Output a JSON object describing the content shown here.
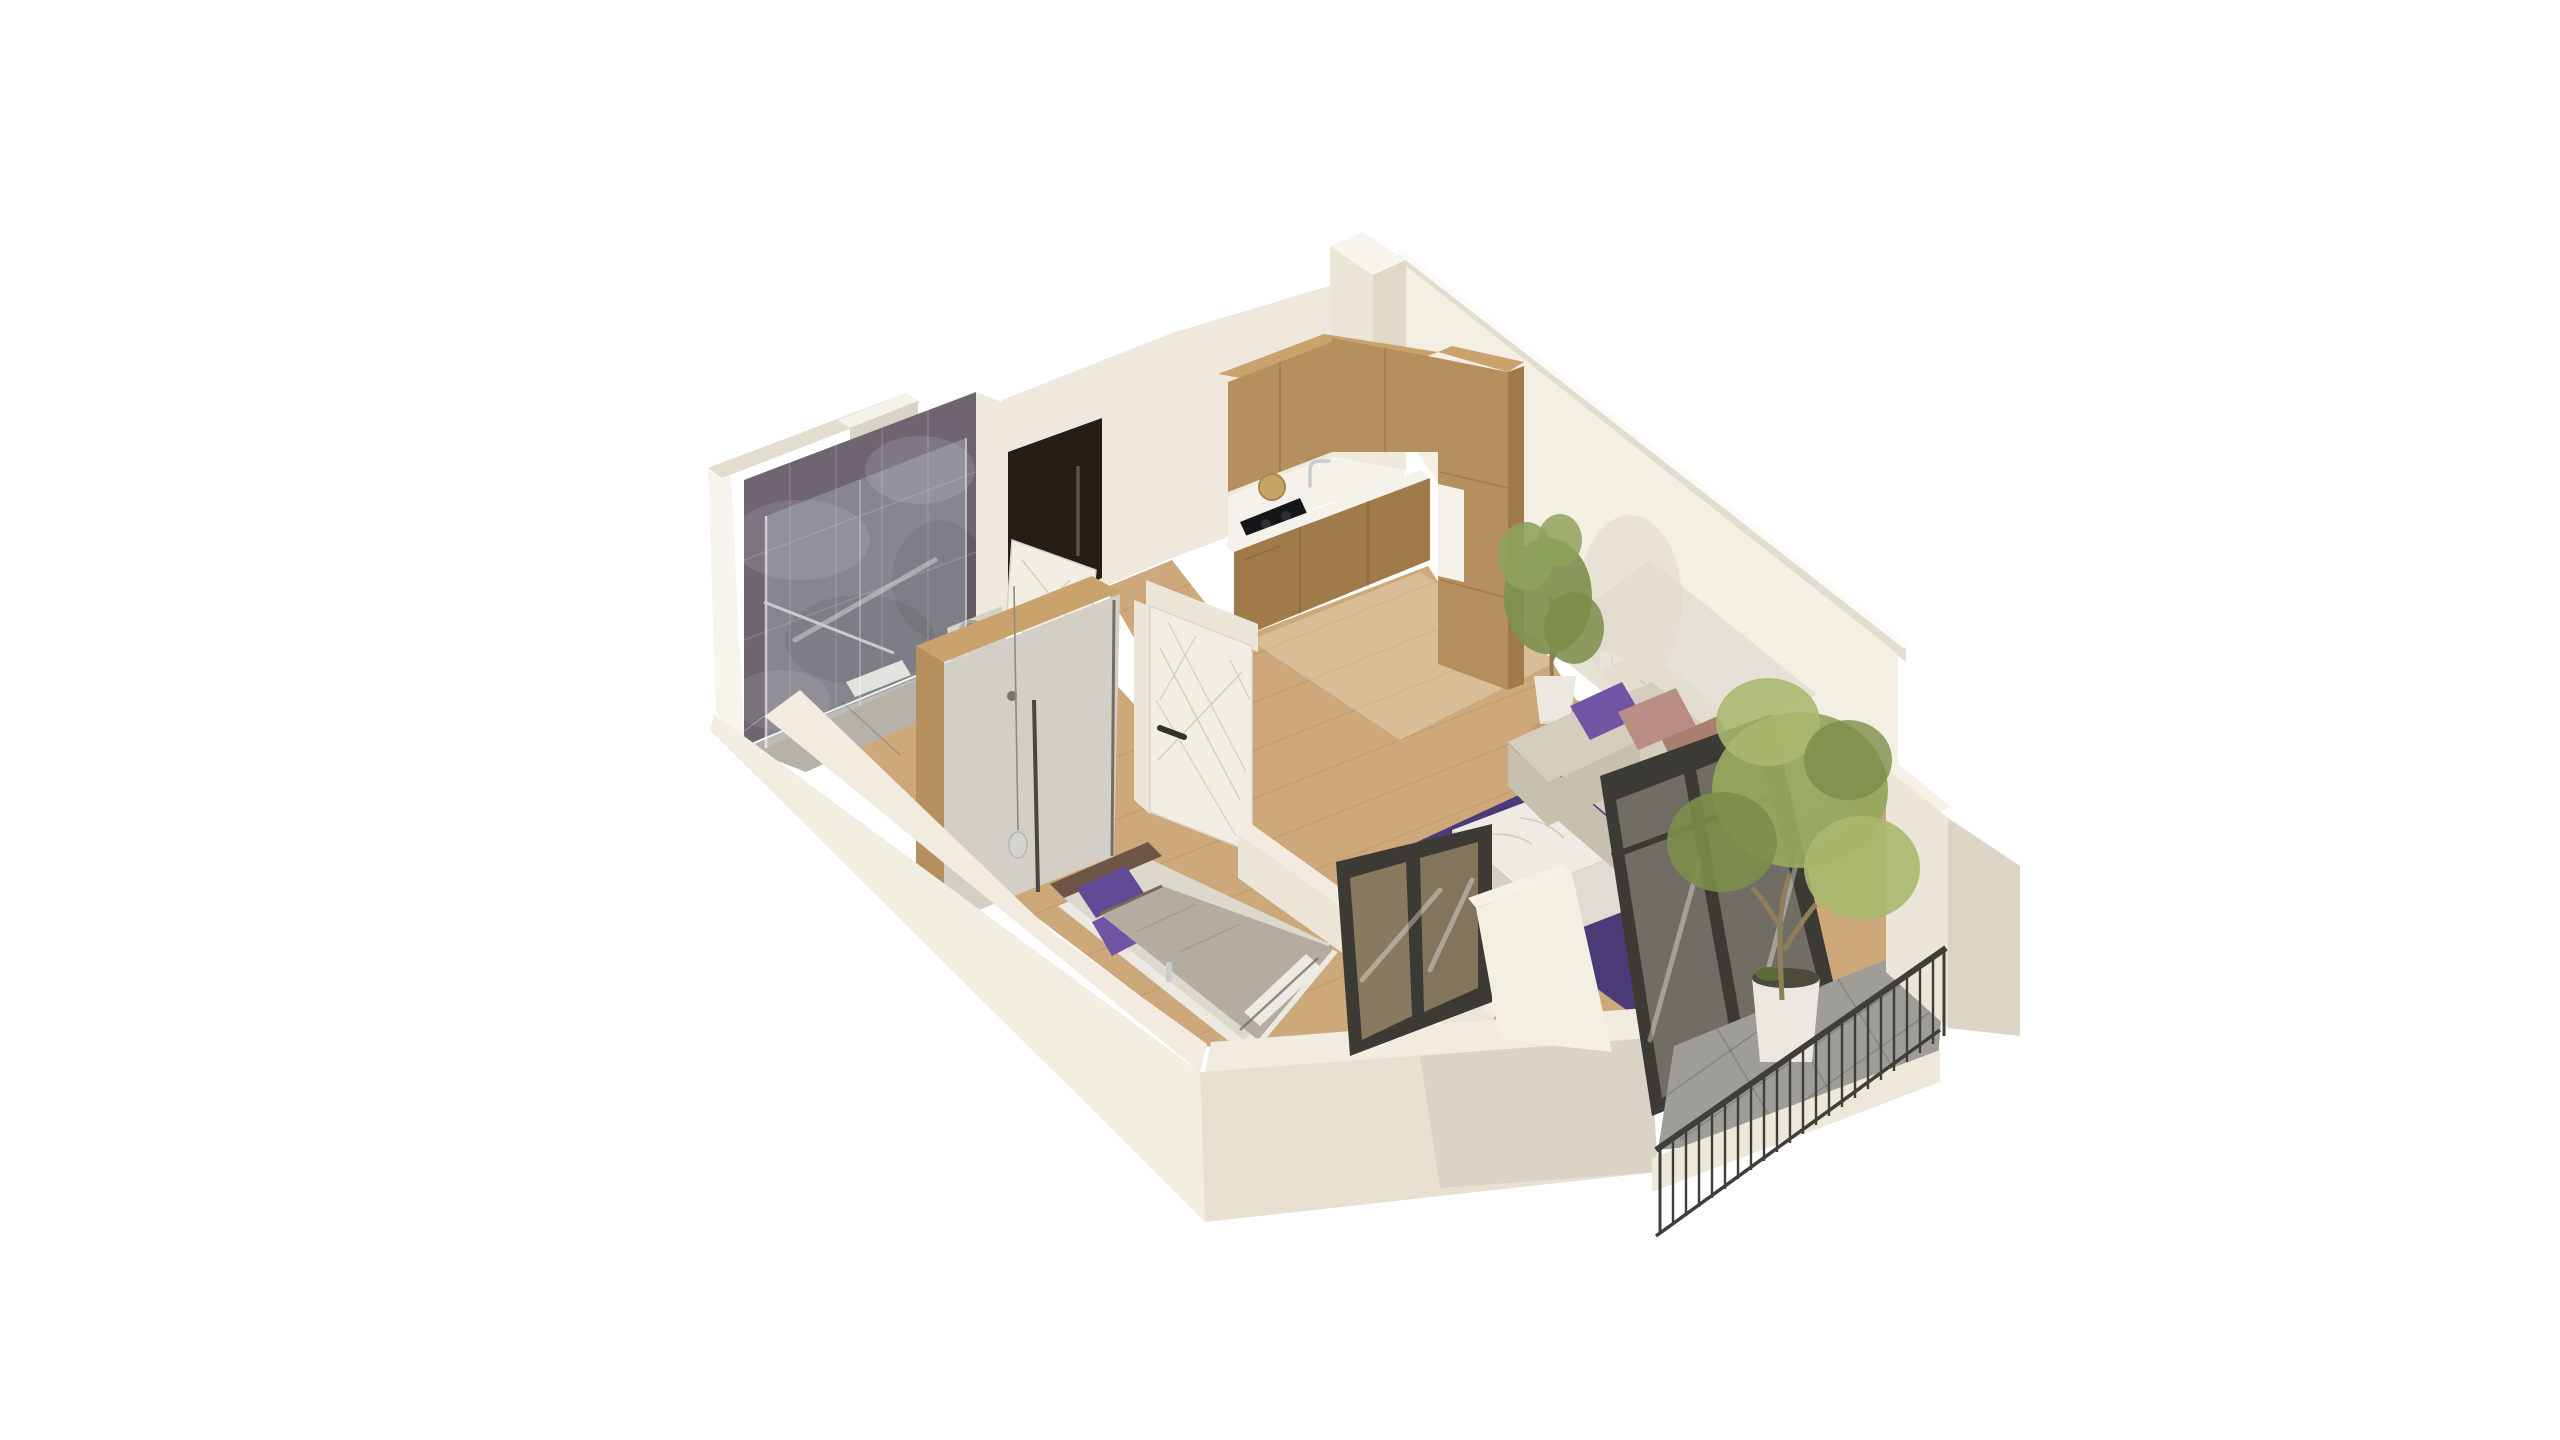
{
  "scene": {
    "type": "isometric-apartment-floorplan-render",
    "description": "Photorealistic 3D dollhouse cutaway of a one-bedroom apartment on a white background",
    "rooms": [
      {
        "name": "bathroom",
        "position": "back-left",
        "features": [
          "dark purple-gray marble tiled walls",
          "glass shower enclosure",
          "chrome towel bar",
          "toilet",
          "vanity with round basin",
          "light tiled floor",
          "bath mat",
          "wall niche"
        ]
      },
      {
        "name": "hallway",
        "position": "center-back",
        "features": [
          "dark entry door with long pull handle",
          "white bathroom door ajar",
          "wood plank floor"
        ]
      },
      {
        "name": "kitchen",
        "position": "back-center",
        "features": [
          "L-shaped light oak cabinets",
          "upper cabinets",
          "tall cabinet column",
          "white countertop and backsplash",
          "black cooktop",
          "chrome faucet",
          "round wooden board",
          "potted plant beside cabinets"
        ]
      },
      {
        "name": "living-room",
        "position": "right",
        "features": [
          "beige corner sofa",
          "purple and dusty-pink cushions",
          "dark purple rug",
          "white marble coffee table",
          "radiator on back wall",
          "black-framed glass sliding door to balcony"
        ]
      },
      {
        "name": "bedroom",
        "position": "front-left",
        "features": [
          "double bed with gray blanket and purple pillows",
          "dark wood headboard",
          "wardrobe with oak frame and gray doors",
          "glass pendant lamp",
          "white paneled door with geometric line pattern",
          "black-framed interior window to living room"
        ]
      },
      {
        "name": "balcony",
        "position": "front-right",
        "features": [
          "gray tile floor",
          "black metal baluster railing",
          "white parapet walls",
          "potted olive tree"
        ]
      }
    ],
    "walls": {
      "style": "cream white plaster, cut low at the front (dollhouse view), full height at the back",
      "tallest_element": "corner pillar at top"
    }
  },
  "colors": {
    "bg": "#ffffff",
    "wallEdgeBright": "#f8f5ee",
    "wallTopBand": "#e3ddd0",
    "wallFaceLight": "#f4efe3",
    "wallFaceMid": "#ece6d9",
    "wallFaceShadow": "#e0d9ca",
    "wallOuterLeft": "#f3eee2",
    "wallOuterRight": "#e8e1d2",
    "wallCutBand": "#f1ecdf",
    "interiorWall": "#efe9dd",
    "niche": "#f5f2e9",
    "nicheShadow": "#d9d3c6",
    "marbleBase": "#6e6570",
    "marbleDark": "#5a525c",
    "marbleLight": "#837a86",
    "entryDoor": "#241d18",
    "entryDoorHandle": "#5a5148",
    "whiteDoor": "#f2eee4",
    "doorPattern": "#d7d1c3",
    "doorHandleDark": "#35302a",
    "woodCabinet": "#b68f5e",
    "woodCabinetTop": "#c9a26c",
    "woodCabinetDark": "#a07a49",
    "counterWhite": "#f4f2eb",
    "cooktopBlack": "#15151a",
    "boardWood": "#c8a366",
    "floorWood": "#cda87a",
    "floorWoodHall": "#c39e6e",
    "floorPlank": "#b28a5e",
    "bathFloor": "#b7b2a9",
    "bathMat": "#e9e7e0",
    "fixtureWhite": "#efede6",
    "vanityGray": "#d6d2c8",
    "basinGray": "#a7a49c",
    "glassBlue": "#cedcde",
    "chrome": "#c9cbcc",
    "rugPurple": "#4a3a78",
    "tableMarble": "#edebe4",
    "tableSide": "#dfdcd2",
    "tableSideDark": "#d4d1c6",
    "sofaBack": "#e3ddcf",
    "sofaSeat": "#d5cdbd",
    "sofaFront": "#c8c0ae",
    "pillowPurple": "#6f55a4",
    "pillowPurpleDark": "#5f4a96",
    "pillowPink": "#b98f85",
    "pillowPinkDark": "#a9806f",
    "frameDark": "#3c3a34",
    "railDark": "#3f3e39",
    "balconyFloor": "#9e9d97",
    "balconySlab": "#eee8da",
    "parapetFace": "#ece6d8",
    "parapetTop": "#f5f1e6",
    "parapetSide": "#dcd5c5",
    "treeGreen": "#96a75e",
    "treeGreenDark": "#7c8d4a",
    "treeGreenLight": "#aab86e",
    "plantGreen": "#7e9150",
    "plantGreenLight": "#8fa25c",
    "trunkBrown": "#8f7f58",
    "potWhite": "#eae8e0",
    "soilDark": "#4c4a3a",
    "mossGreen": "#5d6a39",
    "bedBase": "#ebe9e1",
    "bedMattress": "#dcd8cd",
    "headboardBrown": "#6f5546",
    "blanketGray": "#b3ac9f",
    "blanketTrim": "#7a675c",
    "sheetWhite": "#eceae2",
    "wardrobeDoor": "#d3cfc6",
    "wardrobeDivider": "#4b463e",
    "windowFloorTint": "#c9ad83",
    "radiatorWhite": "#f4f2ea"
  }
}
